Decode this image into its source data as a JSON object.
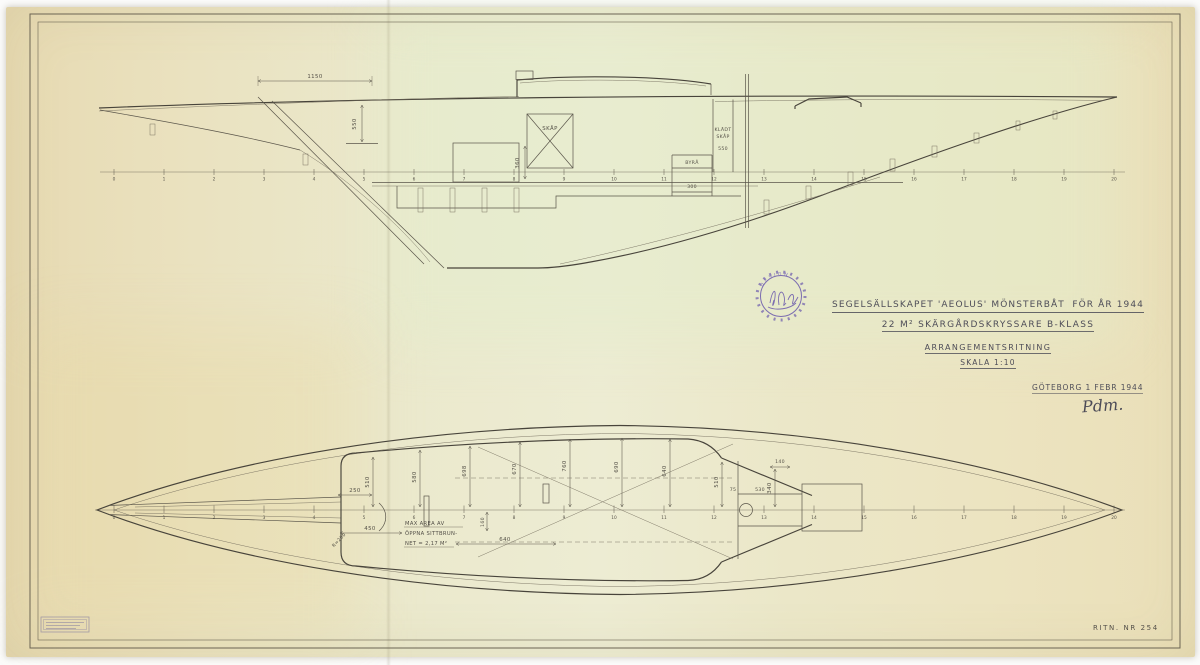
{
  "colors": {
    "paper": "#ece7c8",
    "ink": "#5a554a",
    "pencil": "#4e4d58",
    "stamp_purple": "#7b6cb0"
  },
  "sheet": {
    "stamp_text": "DESIGN",
    "title_line1a": "SEGELSÄLLSKAPET 'AEOLUS' MÖNSTERBÅT",
    "title_line1b": "FÖR ÅR 1944",
    "title_line2": "22 M² SKÄRGÅRDSKRYSSARE B-KLASS",
    "title_line3": "ARRANGEMENTSRITNING",
    "title_line4": "SKALA 1:10",
    "place_date": "GÖTEBORG 1 FEBR 1944",
    "signature": "Pdm.",
    "drawing_no": "RITN. NR 254"
  },
  "profile": {
    "stations": [
      "0",
      "1",
      "2",
      "3",
      "4",
      "5",
      "6",
      "7",
      "8",
      "9",
      "10",
      "11",
      "12",
      "13",
      "14",
      "15",
      "16",
      "17",
      "18",
      "19",
      "20"
    ],
    "labels": {
      "dim_overhang": "1150",
      "dim_cockpit_depth": "550",
      "cabinet": "SKÅP",
      "dim_locker_h": "360",
      "wardrobe_1": "KLÄDT",
      "wardrobe_2": "SKÅP",
      "wardrobe_dim": "550",
      "bureau": "BYRÅ",
      "bureau_dim": "300"
    }
  },
  "plan": {
    "stations": [
      "0",
      "1",
      "2",
      "3",
      "4",
      "5",
      "6",
      "7",
      "8",
      "9",
      "10",
      "11",
      "12",
      "13",
      "14",
      "15",
      "16",
      "17",
      "18",
      "19",
      "20"
    ],
    "labels": {
      "dim_250": "250",
      "dim_510_aft": "510",
      "dim_580": "580",
      "dim_698": "698",
      "dim_670": "670",
      "dim_760": "760",
      "dim_690": "690",
      "dim_640_fwd": "640",
      "dim_510_fwd": "510",
      "dim_340": "340",
      "dim_75": "75",
      "dim_530": "530",
      "dim_140": "140",
      "dim_160": "160",
      "dim_640_cockpit": "640",
      "dim_450": "450",
      "corner_radius": "R=200",
      "note_1": "MAX AREA AV",
      "note_2": "ÖPPNA SITTBRUN-",
      "note_3": "NET = 2,17 M²"
    }
  }
}
